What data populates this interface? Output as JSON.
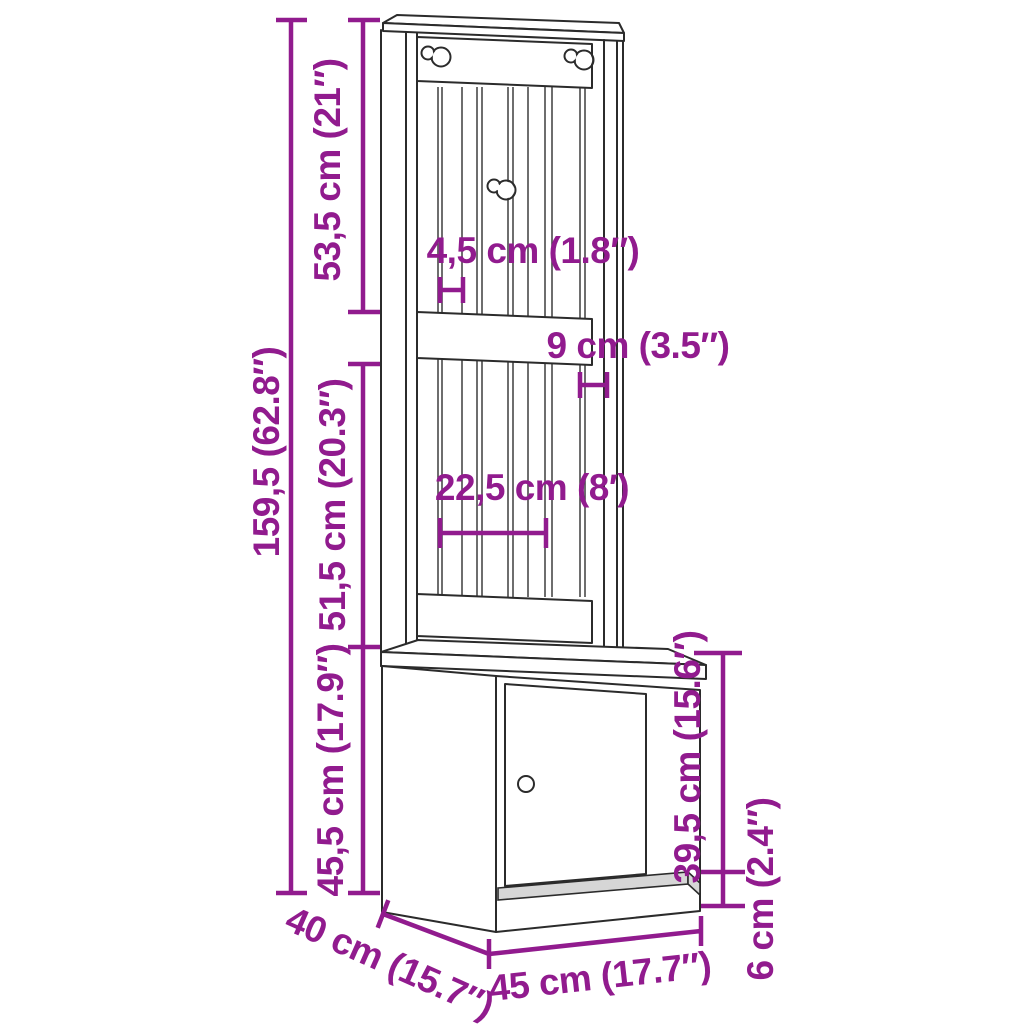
{
  "figure": {
    "type": "furniture-dimension-diagram",
    "product": "hall-tree-with-cabinet",
    "accent_color": "#911B8E",
    "line_color": "#2B2B2B",
    "background_color": "#FFFFFF"
  },
  "dimensions": {
    "total_height": "159,5 (62.8″)",
    "top_section_height": "53,5 cm (21″)",
    "middle_section_height": "51,5 cm (20.3″)",
    "cabinet_section_height": "45,5 cm (17.9″)",
    "slat_width": "4,5 cm (1.8″)",
    "side_rail_width": "9 cm (3.5″)",
    "slat_group_width": "22,5 cm (8′)",
    "door_height": "39,5 cm (15.6″)",
    "plinth_height": "6 cm (2.4″)",
    "depth": "40 cm (15.7″)",
    "width": "45 cm (17.7″)"
  }
}
